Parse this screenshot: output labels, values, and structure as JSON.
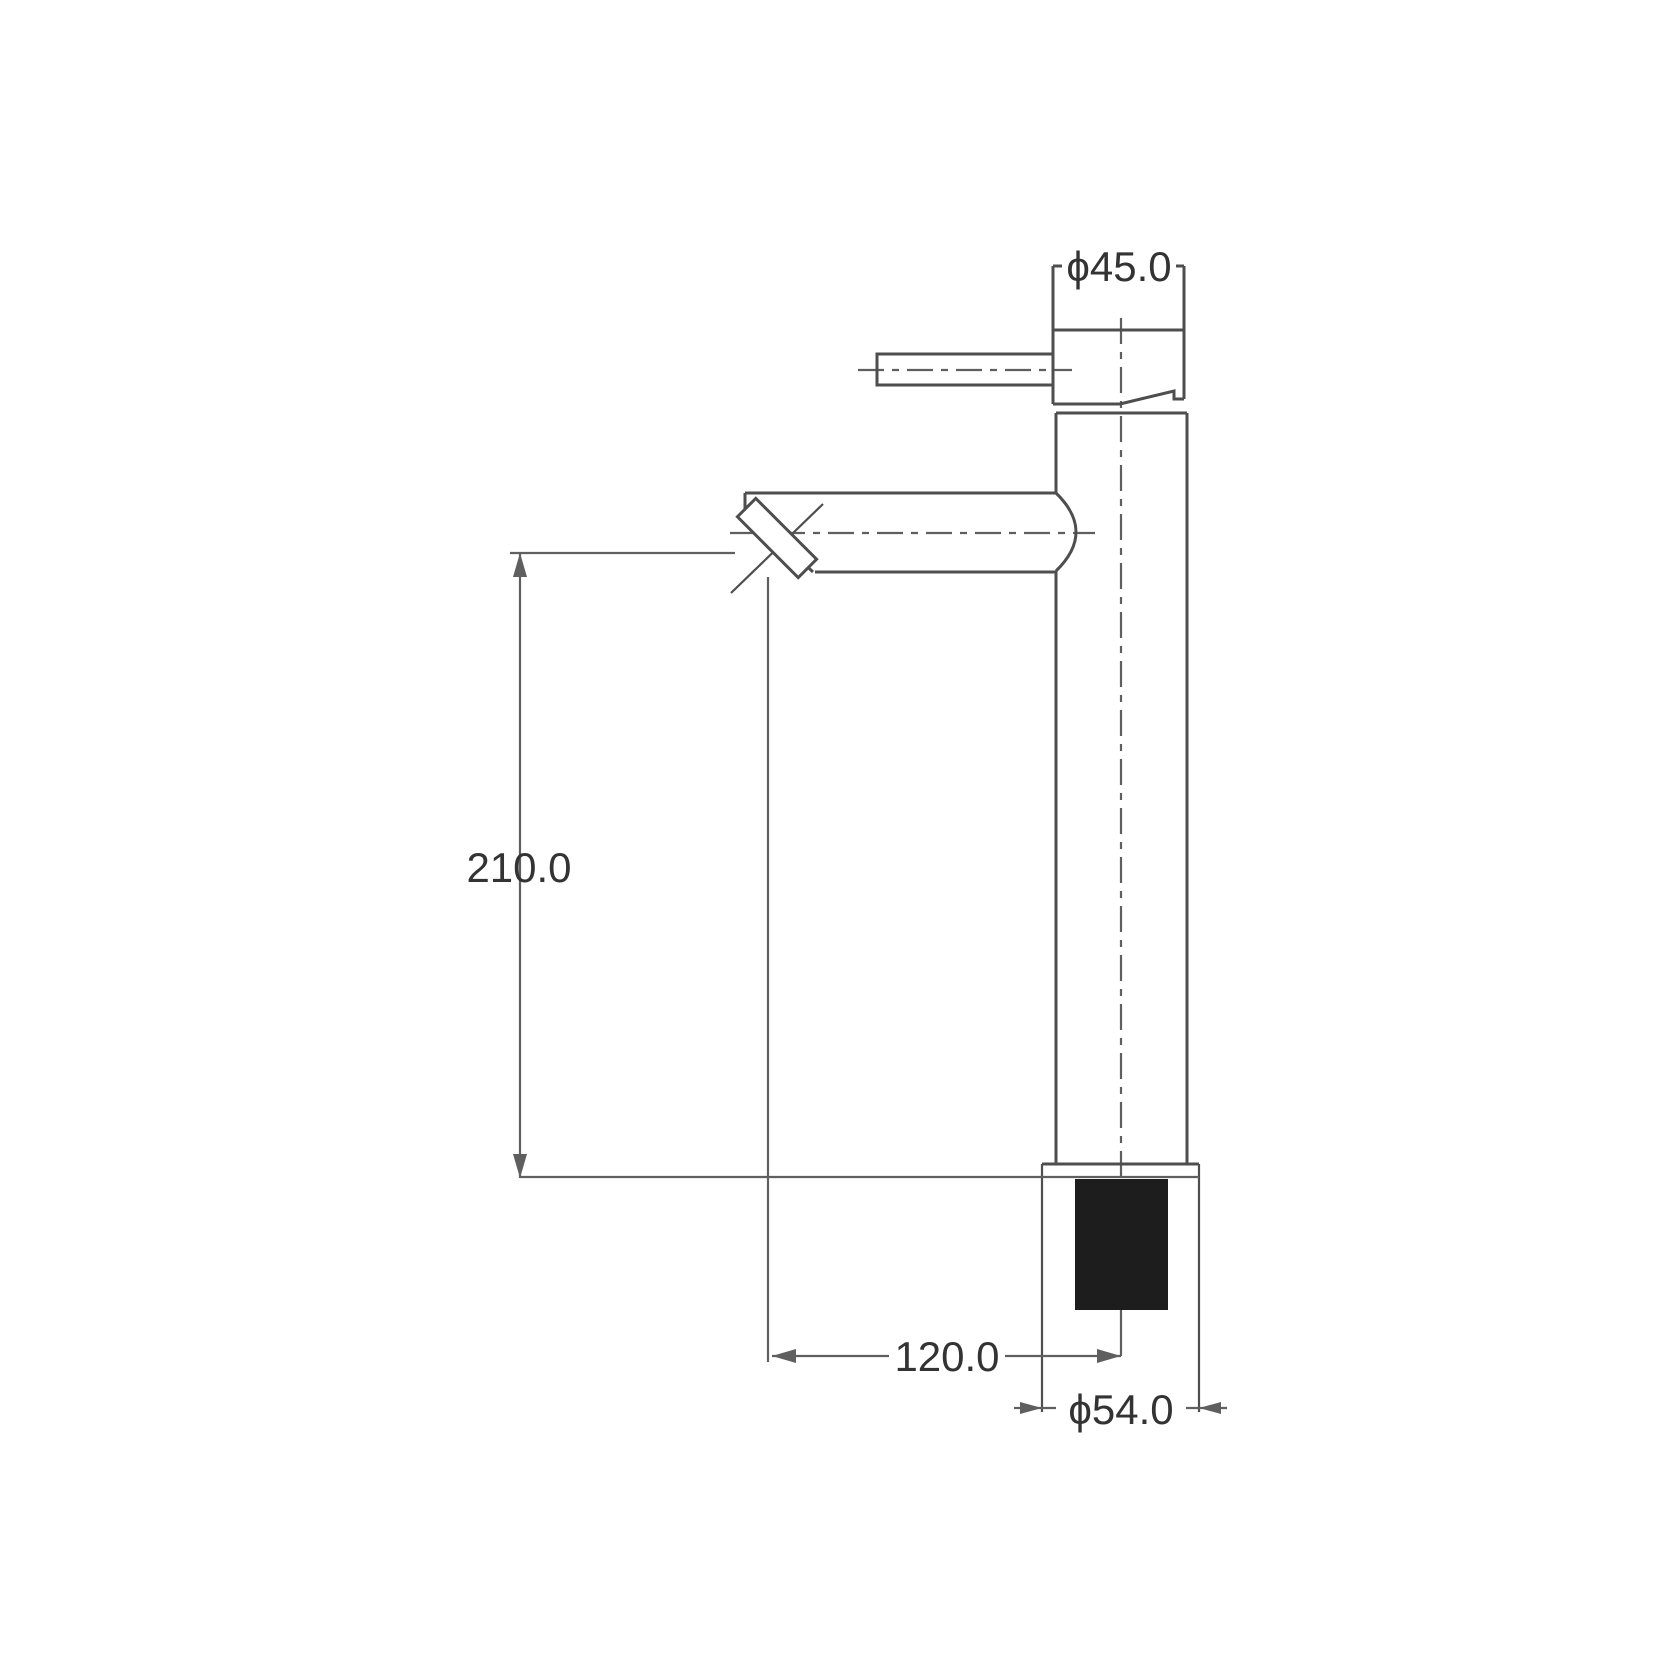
{
  "theme": {
    "background": "#ffffff",
    "line_color": "#4e4e4e",
    "thin_line_color": "#5f5f5f",
    "text_color": "#333333",
    "section_fill_color": "#1d1d1d"
  },
  "dimensions": {
    "top_diameter_label": "ϕ45.0",
    "overall_height_label": "210.0",
    "spout_reach_label": "120.0",
    "base_diameter_label": "ϕ54.0"
  }
}
